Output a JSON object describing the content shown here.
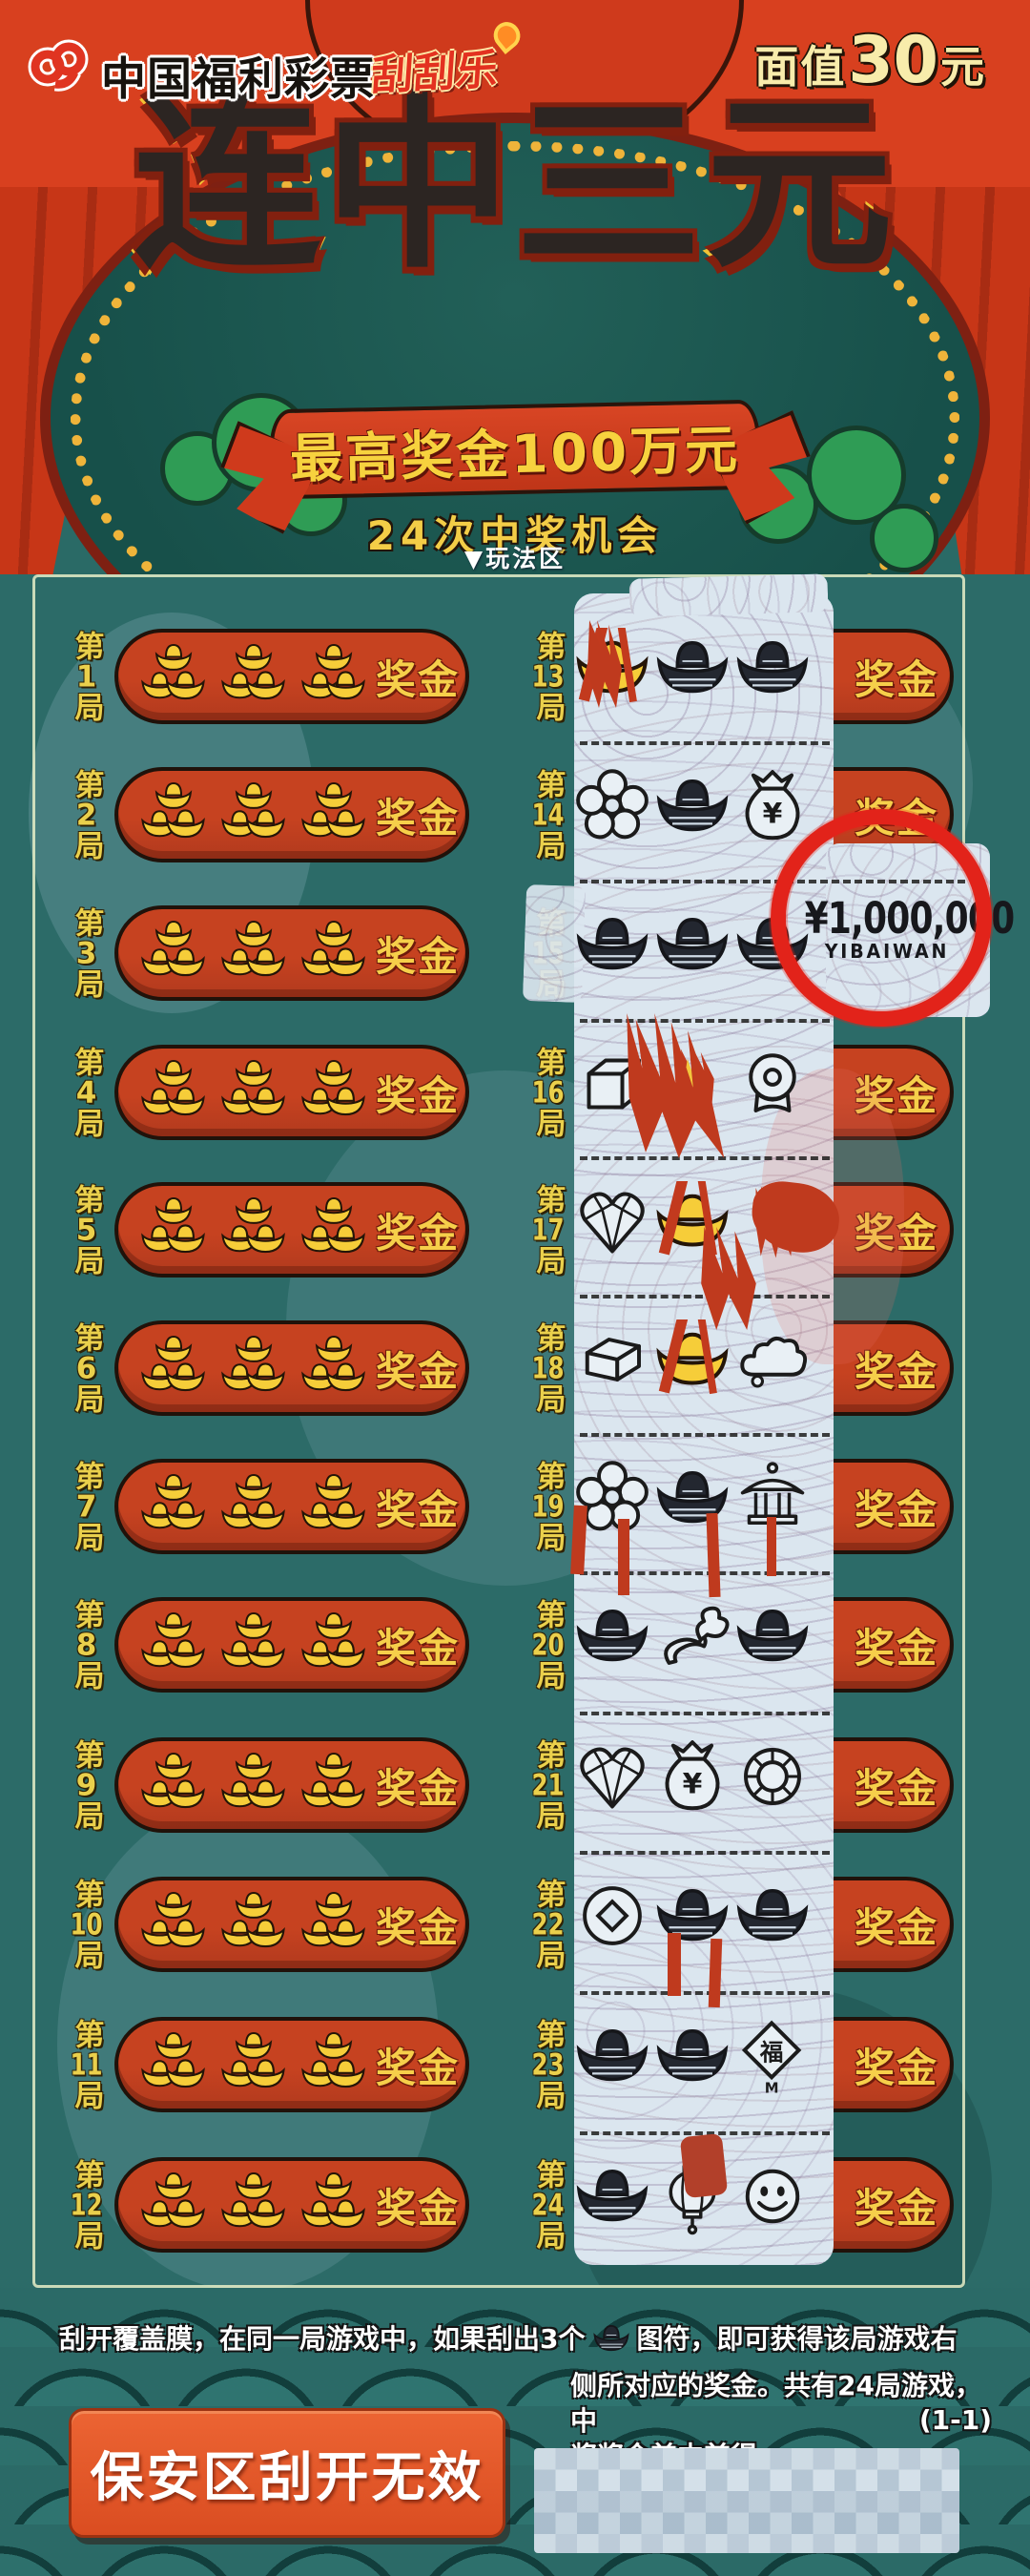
{
  "header": {
    "brand": "中国福利彩票",
    "scratch_brand": "刮刮乐",
    "face_value": {
      "label": "面值",
      "number": "30",
      "unit": "元"
    },
    "title": "连中三元",
    "banner": "最高奖金100万元",
    "chances": "24次中奖机会",
    "play_area_marker": "▼玩法区"
  },
  "game": {
    "label_prefix": "第",
    "label_suffix": "局",
    "prize_label": "奖金",
    "left_rows": [
      "1",
      "2",
      "3",
      "4",
      "5",
      "6",
      "7",
      "8",
      "9",
      "10",
      "11",
      "12"
    ],
    "right_rows": [
      {
        "num": "13",
        "symbols": [
          "ingot-partial",
          "ingot",
          "ingot"
        ]
      },
      {
        "num": "14",
        "symbols": [
          "flower",
          "ingot",
          "money-bag"
        ]
      },
      {
        "num": "15",
        "symbols": [
          "ingot",
          "ingot",
          "ingot"
        ],
        "revealed_prize": "¥1,000,000",
        "revealed_prize_pinyin": "YIBAIWAN"
      },
      {
        "num": "16",
        "symbols": [
          "cube",
          "foil-remnant",
          "medal"
        ]
      },
      {
        "num": "17",
        "symbols": [
          "heart-gem",
          "ingot-partial",
          "foil-remnant"
        ]
      },
      {
        "num": "18",
        "symbols": [
          "gold-bar",
          "ingot-partial",
          "cloud"
        ]
      },
      {
        "num": "19",
        "symbols": [
          "flower",
          "ingot",
          "pavilion"
        ]
      },
      {
        "num": "20",
        "symbols": [
          "ingot",
          "ruyi",
          "ingot"
        ]
      },
      {
        "num": "21",
        "symbols": [
          "heart-gem",
          "money-bag",
          "ring"
        ]
      },
      {
        "num": "22",
        "symbols": [
          "coin",
          "ingot",
          "ingot"
        ]
      },
      {
        "num": "23",
        "symbols": [
          "ingot",
          "ingot",
          "fu-diamond"
        ]
      },
      {
        "num": "24",
        "symbols": [
          "ingot",
          "lantern",
          "smiley"
        ]
      }
    ],
    "fu_char": "福",
    "fu_mark": "M",
    "bag_currency": "¥"
  },
  "highlight": {
    "amount": "¥1,000,000",
    "pinyin": "YIBAIWAN"
  },
  "footer": {
    "instruction_part1": "刮开覆盖膜，在同一局游戏中，如果刮出3个",
    "instruction_part2": "图符，即可获得该局游戏右",
    "instruction_part3": "侧所对应的奖金。共有24局游戏，中",
    "instruction_part4": "奖奖金兼中兼得。",
    "page_code": "(1-1)",
    "security_text": "保安区刮开无效"
  },
  "colors": {
    "header_red": "#d8401f",
    "board_teal": "#2c6b68",
    "pill_red": "#bf3c1f",
    "gold": "#f2c335",
    "scratch_film": "#dbe6ef",
    "highlight_circle": "#e2231a"
  }
}
